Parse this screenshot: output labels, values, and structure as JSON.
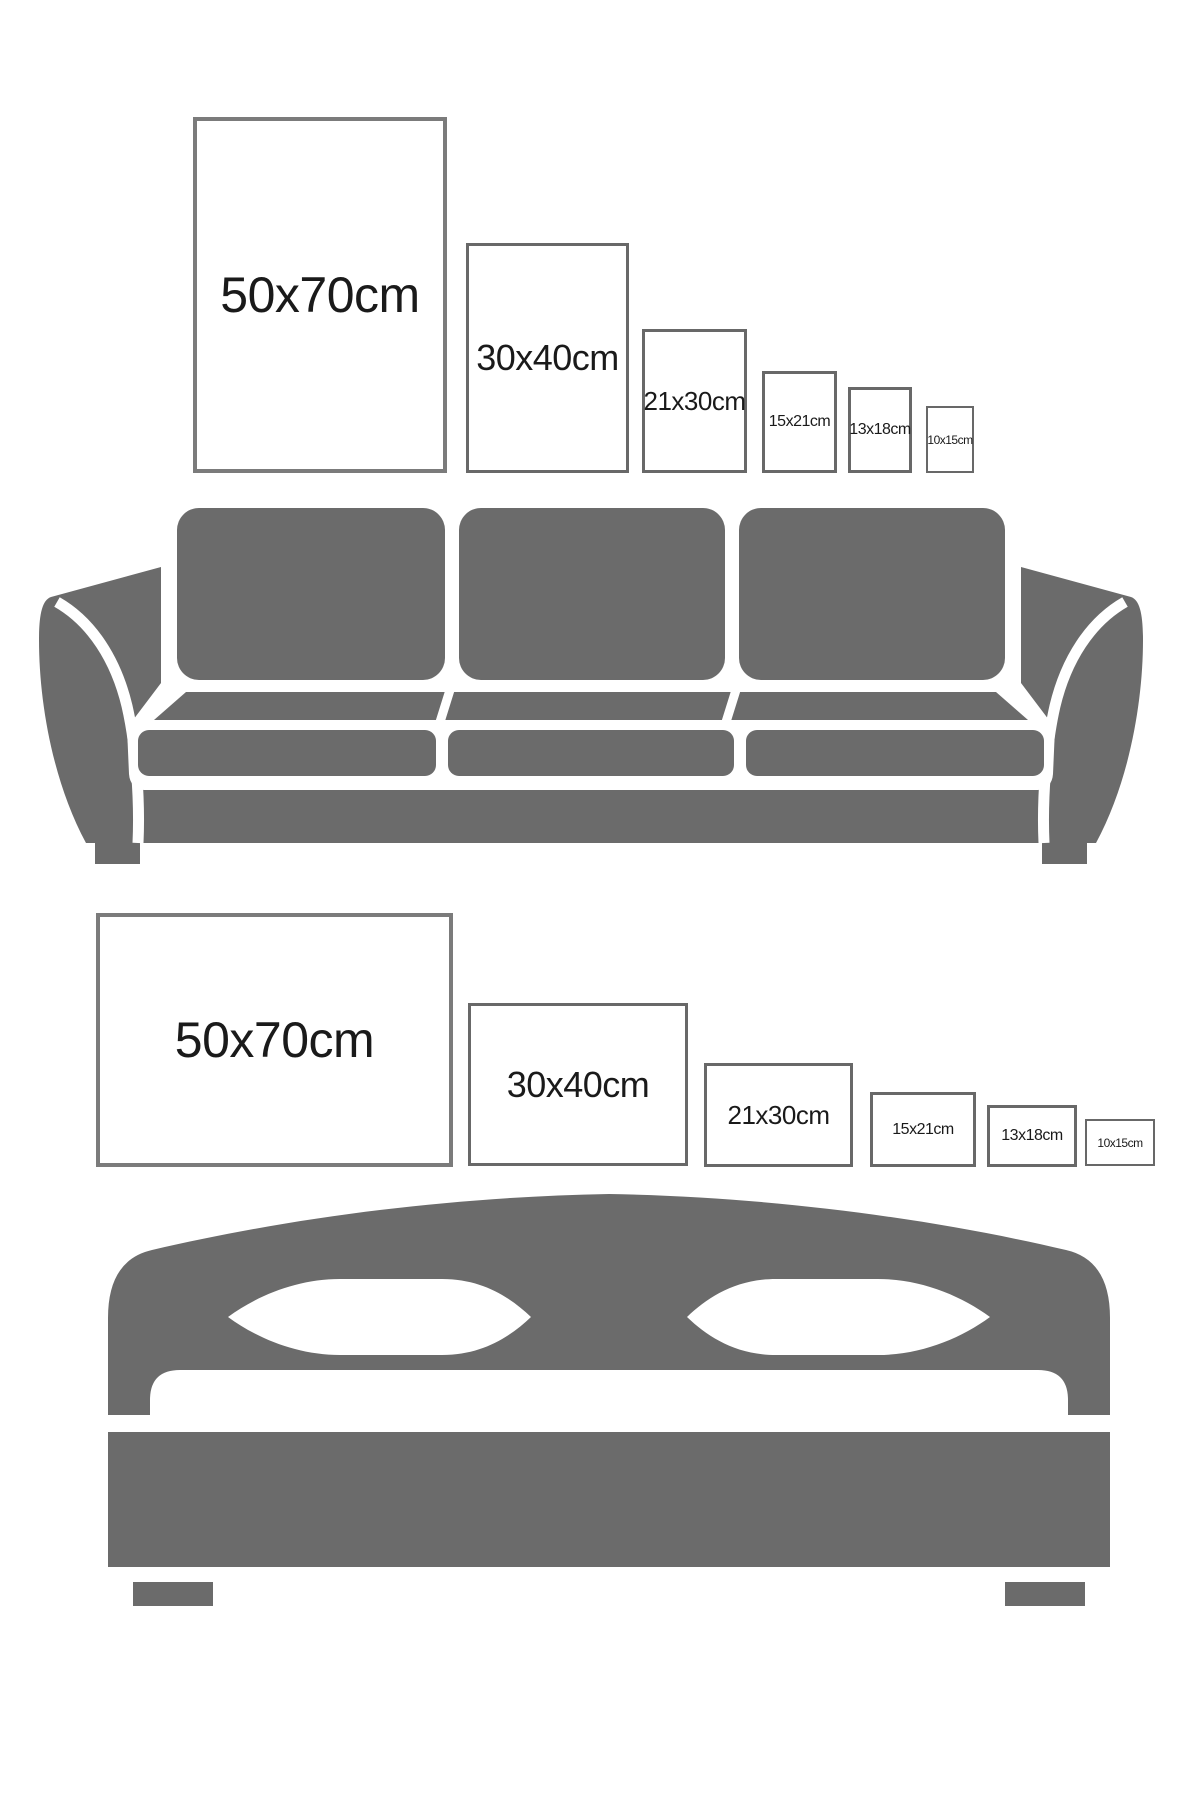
{
  "colors": {
    "background": "#ffffff",
    "furniture": "#6b6b6b",
    "frame_border_large": "#7b7b7b",
    "frame_border_small": "#686868",
    "text": "#1a1a1a"
  },
  "sections": [
    {
      "name": "sofa",
      "furniture_icon": "sofa-icon",
      "orientation": "portrait",
      "frames": [
        {
          "label": "50x70cm"
        },
        {
          "label": "30x40cm"
        },
        {
          "label": "21x30cm"
        },
        {
          "label": "15x21cm"
        },
        {
          "label": "13x18cm"
        },
        {
          "label": "10x15cm"
        }
      ]
    },
    {
      "name": "bed",
      "furniture_icon": "bed-icon",
      "orientation": "landscape",
      "frames": [
        {
          "label": "50x70cm"
        },
        {
          "label": "30x40cm"
        },
        {
          "label": "21x30cm"
        },
        {
          "label": "15x21cm"
        },
        {
          "label": "13x18cm"
        },
        {
          "label": "10x15cm"
        }
      ]
    }
  ]
}
